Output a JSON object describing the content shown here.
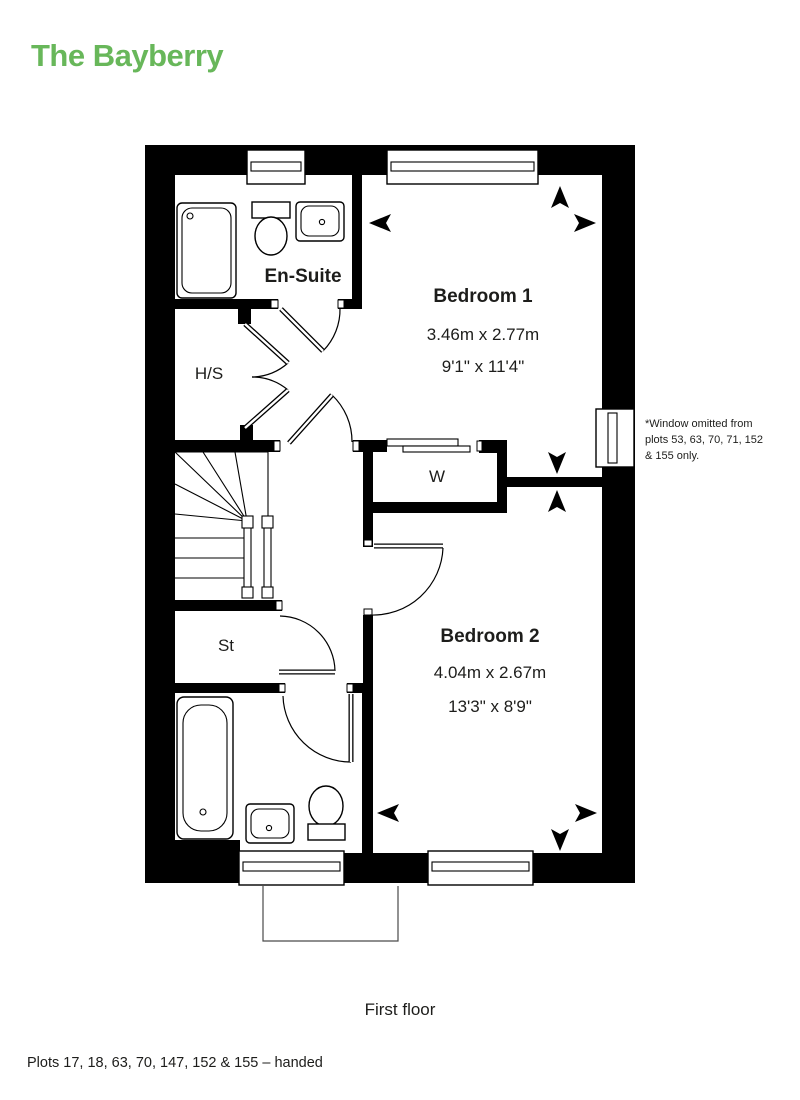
{
  "title": "The Bayberry",
  "colors": {
    "accent_green": "#68b75a",
    "plan_black": "#000000",
    "text": "#1d1d1b"
  },
  "rooms": {
    "ensuite": {
      "label": "En-Suite"
    },
    "hs": {
      "label": "H/S"
    },
    "wardrobe": {
      "label": "W"
    },
    "store": {
      "label": "St"
    },
    "bathroom": {
      "label": "Bathroom"
    },
    "bedroom1": {
      "label": "Bedroom 1",
      "metric": "3.46m x 2.77m",
      "imperial": "9'1\" x 11'4\""
    },
    "bedroom2": {
      "label": "Bedroom 2",
      "metric": "4.04m x 2.67m",
      "imperial": "13'3\" x 8'9\""
    }
  },
  "window_note": {
    "line1": "*Window omitted from",
    "line2": "plots 53, 63, 70, 71, 152",
    "line3": "& 155 only."
  },
  "floor_caption": "First floor",
  "footer_note": "Plots 17, 18, 63, 70, 147, 152 & 155 – handed"
}
